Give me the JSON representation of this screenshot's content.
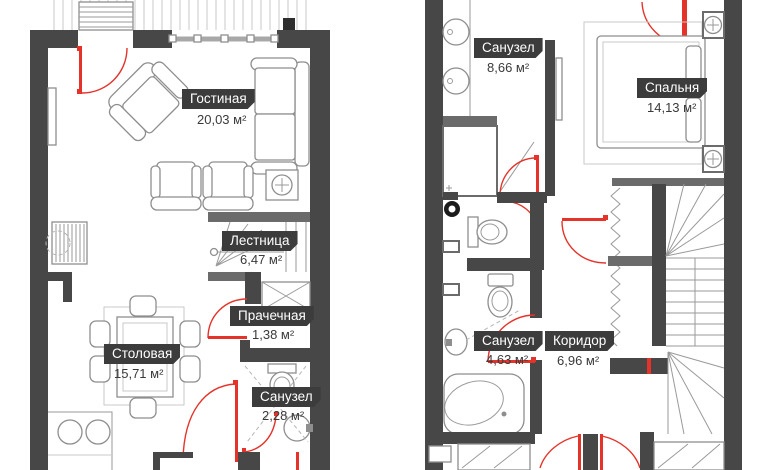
{
  "rooms": [
    {
      "name": "Гостиная",
      "area": "20,03 м²"
    },
    {
      "name": "Лестница",
      "area": "6,47 м²"
    },
    {
      "name": "Прачечная",
      "area": "1,38 м²"
    },
    {
      "name": "Столовая",
      "area": "15,71 м²"
    },
    {
      "name": "Санузел",
      "area": "2,28 м²"
    },
    {
      "name": "Санузел",
      "area": "8,66 м²"
    },
    {
      "name": "Спальня",
      "area": "14,13 м²"
    },
    {
      "name": "Санузел",
      "area": "4,63 м²"
    },
    {
      "name": "Коридор",
      "area": "6,96 м²"
    }
  ],
  "colors": {
    "wall": "#474747",
    "door": "#e5332a",
    "furniture_line": "#8e8e8e",
    "label_background": "#3c3c3c",
    "label_text": "#ffffff"
  }
}
